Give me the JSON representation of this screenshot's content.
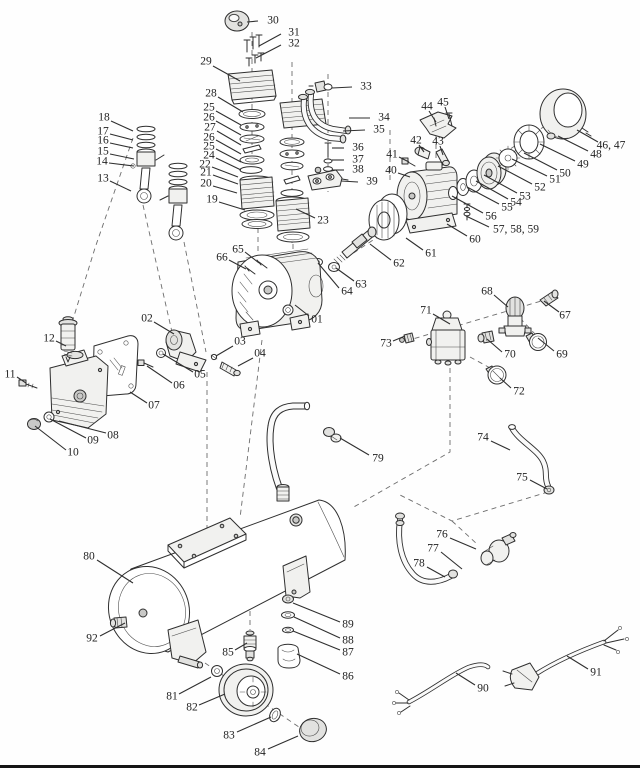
{
  "diagram": {
    "type": "exploded-parts-diagram",
    "subject": "portable air compressor",
    "background": "#fefefe",
    "line_color": "#2f2f2f",
    "label_color": "#222222",
    "border_bottom_color": "#151515",
    "labels": [
      {
        "text": "30",
        "tx": 273,
        "ty": 21,
        "x1": 258,
        "y1": 21,
        "x2": 247,
        "y2": 22
      },
      {
        "text": "31",
        "tx": 294,
        "ty": 33,
        "x1": 281,
        "y1": 34,
        "x2": 259,
        "y2": 46
      },
      {
        "text": "32",
        "tx": 294,
        "ty": 44,
        "x1": 281,
        "y1": 45,
        "x2": 256,
        "y2": 58
      },
      {
        "text": "29",
        "tx": 206,
        "ty": 62,
        "x1": 213,
        "y1": 66,
        "x2": 240,
        "y2": 81
      },
      {
        "text": "28",
        "tx": 211,
        "ty": 94,
        "x1": 218,
        "y1": 97,
        "x2": 243,
        "y2": 112
      },
      {
        "text": "25",
        "tx": 209,
        "ty": 108,
        "x1": 216,
        "y1": 111,
        "x2": 241,
        "y2": 125
      },
      {
        "text": "26",
        "tx": 209,
        "ty": 118,
        "x1": 216,
        "y1": 121,
        "x2": 241,
        "y2": 135
      },
      {
        "text": "27",
        "tx": 210,
        "ty": 128,
        "x1": 217,
        "y1": 131,
        "x2": 241,
        "y2": 145
      },
      {
        "text": "26",
        "tx": 209,
        "ty": 138,
        "x1": 216,
        "y1": 140,
        "x2": 241,
        "y2": 154
      },
      {
        "text": "25",
        "tx": 209,
        "ty": 147,
        "x1": 216,
        "y1": 149,
        "x2": 241,
        "y2": 162
      },
      {
        "text": "24",
        "tx": 209,
        "ty": 156,
        "x1": 216,
        "y1": 158,
        "x2": 241,
        "y2": 170
      },
      {
        "text": "22",
        "tx": 205,
        "ty": 165,
        "x1": 212,
        "y1": 167,
        "x2": 238,
        "y2": 177
      },
      {
        "text": "21",
        "tx": 206,
        "ty": 173,
        "x1": 213,
        "y1": 175,
        "x2": 238,
        "y2": 184
      },
      {
        "text": "20",
        "tx": 206,
        "ty": 184,
        "x1": 213,
        "y1": 186,
        "x2": 237,
        "y2": 193
      },
      {
        "text": "19",
        "tx": 212,
        "ty": 200,
        "x1": 219,
        "y1": 202,
        "x2": 245,
        "y2": 210
      },
      {
        "text": "23",
        "tx": 323,
        "ty": 221,
        "x1": 315,
        "y1": 218,
        "x2": 296,
        "y2": 209
      },
      {
        "text": "18",
        "tx": 104,
        "ty": 118,
        "x1": 111,
        "y1": 121,
        "x2": 133,
        "y2": 131
      },
      {
        "text": "17",
        "tx": 103,
        "ty": 132,
        "x1": 110,
        "y1": 134,
        "x2": 133,
        "y2": 140
      },
      {
        "text": "16",
        "tx": 103,
        "ty": 141,
        "x1": 110,
        "y1": 143,
        "x2": 133,
        "y2": 148
      },
      {
        "text": "15",
        "tx": 103,
        "ty": 152,
        "x1": 110,
        "y1": 154,
        "x2": 134,
        "y2": 159
      },
      {
        "text": "14",
        "tx": 102,
        "ty": 162,
        "x1": 109,
        "y1": 163,
        "x2": 134,
        "y2": 166
      },
      {
        "text": "13",
        "tx": 103,
        "ty": 179,
        "x1": 110,
        "y1": 181,
        "x2": 131,
        "y2": 191
      },
      {
        "text": "33",
        "tx": 366,
        "ty": 87,
        "x1": 352,
        "y1": 87,
        "x2": 332,
        "y2": 88
      },
      {
        "text": "34",
        "tx": 384,
        "ty": 118,
        "x1": 370,
        "y1": 118,
        "x2": 349,
        "y2": 118
      },
      {
        "text": "35",
        "tx": 379,
        "ty": 130,
        "x1": 365,
        "y1": 130,
        "x2": 343,
        "y2": 131
      },
      {
        "text": "36",
        "tx": 358,
        "ty": 148,
        "x1": 344,
        "y1": 148,
        "x2": 332,
        "y2": 148
      },
      {
        "text": "37",
        "tx": 358,
        "ty": 160,
        "x1": 344,
        "y1": 160,
        "x2": 332,
        "y2": 160
      },
      {
        "text": "38",
        "tx": 358,
        "ty": 170,
        "x1": 344,
        "y1": 170,
        "x2": 332,
        "y2": 170
      },
      {
        "text": "39",
        "tx": 372,
        "ty": 182,
        "x1": 358,
        "y1": 182,
        "x2": 341,
        "y2": 181
      },
      {
        "text": "44",
        "tx": 427,
        "ty": 107,
        "x1": 429,
        "y1": 111,
        "x2": 436,
        "y2": 122
      },
      {
        "text": "45",
        "tx": 443,
        "ty": 103,
        "x1": 445,
        "y1": 107,
        "x2": 449,
        "y2": 119
      },
      {
        "text": "42",
        "tx": 416,
        "ty": 141,
        "x1": 419,
        "y1": 145,
        "x2": 424,
        "y2": 152
      },
      {
        "text": "43",
        "tx": 438,
        "ty": 142,
        "x1": 440,
        "y1": 146,
        "x2": 443,
        "y2": 155
      },
      {
        "text": "41",
        "tx": 392,
        "ty": 155,
        "x1": 399,
        "y1": 157,
        "x2": 409,
        "y2": 162
      },
      {
        "text": "40",
        "tx": 391,
        "ty": 171,
        "x1": 398,
        "y1": 173,
        "x2": 410,
        "y2": 177
      },
      {
        "text": "46, 47",
        "tx": 611,
        "ty": 146,
        "x1": 598,
        "y1": 142,
        "x2": 577,
        "y2": 130
      },
      {
        "text": "48",
        "tx": 596,
        "ty": 155,
        "x1": 588,
        "y1": 151,
        "x2": 558,
        "y2": 136
      },
      {
        "text": "49",
        "tx": 583,
        "ty": 165,
        "x1": 575,
        "y1": 161,
        "x2": 540,
        "y2": 144
      },
      {
        "text": "50",
        "tx": 565,
        "ty": 174,
        "x1": 557,
        "y1": 170,
        "x2": 524,
        "y2": 153
      },
      {
        "text": "51",
        "tx": 555,
        "ty": 180,
        "x1": 547,
        "y1": 176,
        "x2": 512,
        "y2": 159
      },
      {
        "text": "52",
        "tx": 540,
        "ty": 188,
        "x1": 532,
        "y1": 184,
        "x2": 498,
        "y2": 166
      },
      {
        "text": "53",
        "tx": 525,
        "ty": 197,
        "x1": 517,
        "y1": 193,
        "x2": 484,
        "y2": 175
      },
      {
        "text": "54",
        "tx": 516,
        "ty": 203,
        "x1": 508,
        "y1": 199,
        "x2": 476,
        "y2": 181
      },
      {
        "text": "55",
        "tx": 507,
        "ty": 208,
        "x1": 499,
        "y1": 204,
        "x2": 467,
        "y2": 187
      },
      {
        "text": "56",
        "tx": 491,
        "ty": 217,
        "x1": 483,
        "y1": 213,
        "x2": 452,
        "y2": 196
      },
      {
        "text": "57, 58, 59",
        "tx": 516,
        "ty": 230,
        "x1": 489,
        "y1": 227,
        "x2": 466,
        "y2": 216
      },
      {
        "text": "60",
        "tx": 475,
        "ty": 240,
        "x1": 467,
        "y1": 236,
        "x2": 447,
        "y2": 224
      },
      {
        "text": "61",
        "tx": 431,
        "ty": 254,
        "x1": 423,
        "y1": 250,
        "x2": 406,
        "y2": 238
      },
      {
        "text": "62",
        "tx": 399,
        "ty": 264,
        "x1": 391,
        "y1": 260,
        "x2": 370,
        "y2": 244
      },
      {
        "text": "63",
        "tx": 361,
        "ty": 285,
        "x1": 354,
        "y1": 281,
        "x2": 336,
        "y2": 268
      },
      {
        "text": "64",
        "tx": 347,
        "ty": 292,
        "x1": 339,
        "y1": 288,
        "x2": 318,
        "y2": 263
      },
      {
        "text": "65",
        "tx": 238,
        "ty": 250,
        "x1": 245,
        "y1": 252,
        "x2": 259,
        "y2": 263
      },
      {
        "text": "66",
        "tx": 222,
        "ty": 258,
        "x1": 229,
        "y1": 260,
        "x2": 246,
        "y2": 269
      },
      {
        "text": "01",
        "tx": 317,
        "ty": 320,
        "x1": 309,
        "y1": 316,
        "x2": 295,
        "y2": 305
      },
      {
        "text": "02",
        "tx": 147,
        "ty": 319,
        "x1": 154,
        "y1": 322,
        "x2": 174,
        "y2": 334
      },
      {
        "text": "03",
        "tx": 240,
        "ty": 342,
        "x1": 233,
        "y1": 346,
        "x2": 216,
        "y2": 356
      },
      {
        "text": "04",
        "tx": 260,
        "ty": 354,
        "x1": 253,
        "y1": 358,
        "x2": 238,
        "y2": 366
      },
      {
        "text": "05",
        "tx": 200,
        "ty": 375,
        "x1": 193,
        "y1": 372,
        "x2": 163,
        "y2": 354
      },
      {
        "text": "06",
        "tx": 179,
        "ty": 386,
        "x1": 172,
        "y1": 383,
        "x2": 147,
        "y2": 366
      },
      {
        "text": "07",
        "tx": 154,
        "ty": 406,
        "x1": 147,
        "y1": 403,
        "x2": 130,
        "y2": 392
      },
      {
        "text": "12",
        "tx": 49,
        "ty": 339,
        "x1": 56,
        "y1": 341,
        "x2": 66,
        "y2": 346
      },
      {
        "text": "11",
        "tx": 10,
        "ty": 375,
        "x1": 17,
        "y1": 377,
        "x2": 26,
        "y2": 383
      },
      {
        "text": "08",
        "tx": 113,
        "ty": 436,
        "x1": 106,
        "y1": 433,
        "x2": 59,
        "y2": 421
      },
      {
        "text": "09",
        "tx": 93,
        "ty": 441,
        "x1": 86,
        "y1": 438,
        "x2": 50,
        "y2": 419
      },
      {
        "text": "10",
        "tx": 73,
        "ty": 453,
        "x1": 66,
        "y1": 450,
        "x2": 35,
        "y2": 426
      },
      {
        "text": "68",
        "tx": 487,
        "ty": 292,
        "x1": 494,
        "y1": 295,
        "x2": 508,
        "y2": 307
      },
      {
        "text": "67",
        "tx": 565,
        "ty": 316,
        "x1": 559,
        "y1": 312,
        "x2": 544,
        "y2": 301
      },
      {
        "text": "71",
        "tx": 426,
        "ty": 311,
        "x1": 433,
        "y1": 314,
        "x2": 450,
        "y2": 324
      },
      {
        "text": "73",
        "tx": 386,
        "ty": 344,
        "x1": 393,
        "y1": 341,
        "x2": 405,
        "y2": 336
      },
      {
        "text": "70",
        "tx": 510,
        "ty": 355,
        "x1": 502,
        "y1": 352,
        "x2": 487,
        "y2": 339
      },
      {
        "text": "69",
        "tx": 562,
        "ty": 355,
        "x1": 554,
        "y1": 351,
        "x2": 538,
        "y2": 338
      },
      {
        "text": "72",
        "tx": 519,
        "ty": 392,
        "x1": 511,
        "y1": 388,
        "x2": 500,
        "y2": 378
      },
      {
        "text": "74",
        "tx": 483,
        "ty": 438,
        "x1": 491,
        "y1": 441,
        "x2": 510,
        "y2": 450
      },
      {
        "text": "75",
        "tx": 522,
        "ty": 478,
        "x1": 530,
        "y1": 480,
        "x2": 547,
        "y2": 489
      },
      {
        "text": "79",
        "tx": 378,
        "ty": 459,
        "x1": 369,
        "y1": 455,
        "x2": 340,
        "y2": 438
      },
      {
        "text": "76",
        "tx": 442,
        "ty": 535,
        "x1": 450,
        "y1": 538,
        "x2": 476,
        "y2": 549
      },
      {
        "text": "77",
        "tx": 433,
        "ty": 549,
        "x1": 441,
        "y1": 552,
        "x2": 462,
        "y2": 569
      },
      {
        "text": "78",
        "tx": 419,
        "ty": 564,
        "x1": 427,
        "y1": 567,
        "x2": 445,
        "y2": 577
      },
      {
        "text": "80",
        "tx": 89,
        "ty": 557,
        "x1": 97,
        "y1": 560,
        "x2": 133,
        "y2": 583
      },
      {
        "text": "92",
        "tx": 92,
        "ty": 639,
        "x1": 100,
        "y1": 636,
        "x2": 125,
        "y2": 623
      },
      {
        "text": "85",
        "tx": 228,
        "ty": 653,
        "x1": 235,
        "y1": 650,
        "x2": 247,
        "y2": 643
      },
      {
        "text": "89",
        "tx": 348,
        "ty": 625,
        "x1": 340,
        "y1": 622,
        "x2": 293,
        "y2": 603
      },
      {
        "text": "88",
        "tx": 348,
        "ty": 641,
        "x1": 340,
        "y1": 638,
        "x2": 294,
        "y2": 617
      },
      {
        "text": "87",
        "tx": 348,
        "ty": 653,
        "x1": 340,
        "y1": 650,
        "x2": 293,
        "y2": 631
      },
      {
        "text": "86",
        "tx": 348,
        "ty": 677,
        "x1": 340,
        "y1": 674,
        "x2": 297,
        "y2": 654
      },
      {
        "text": "81",
        "tx": 172,
        "ty": 697,
        "x1": 179,
        "y1": 694,
        "x2": 211,
        "y2": 677
      },
      {
        "text": "82",
        "tx": 192,
        "ty": 708,
        "x1": 199,
        "y1": 705,
        "x2": 225,
        "y2": 694
      },
      {
        "text": "83",
        "tx": 229,
        "ty": 736,
        "x1": 237,
        "y1": 732,
        "x2": 271,
        "y2": 717
      },
      {
        "text": "84",
        "tx": 260,
        "ty": 753,
        "x1": 268,
        "y1": 749,
        "x2": 298,
        "y2": 736
      },
      {
        "text": "90",
        "tx": 483,
        "ty": 689,
        "x1": 475,
        "y1": 685,
        "x2": 456,
        "y2": 673
      },
      {
        "text": "91",
        "tx": 596,
        "ty": 673,
        "x1": 588,
        "y1": 669,
        "x2": 567,
        "y2": 656
      }
    ]
  }
}
